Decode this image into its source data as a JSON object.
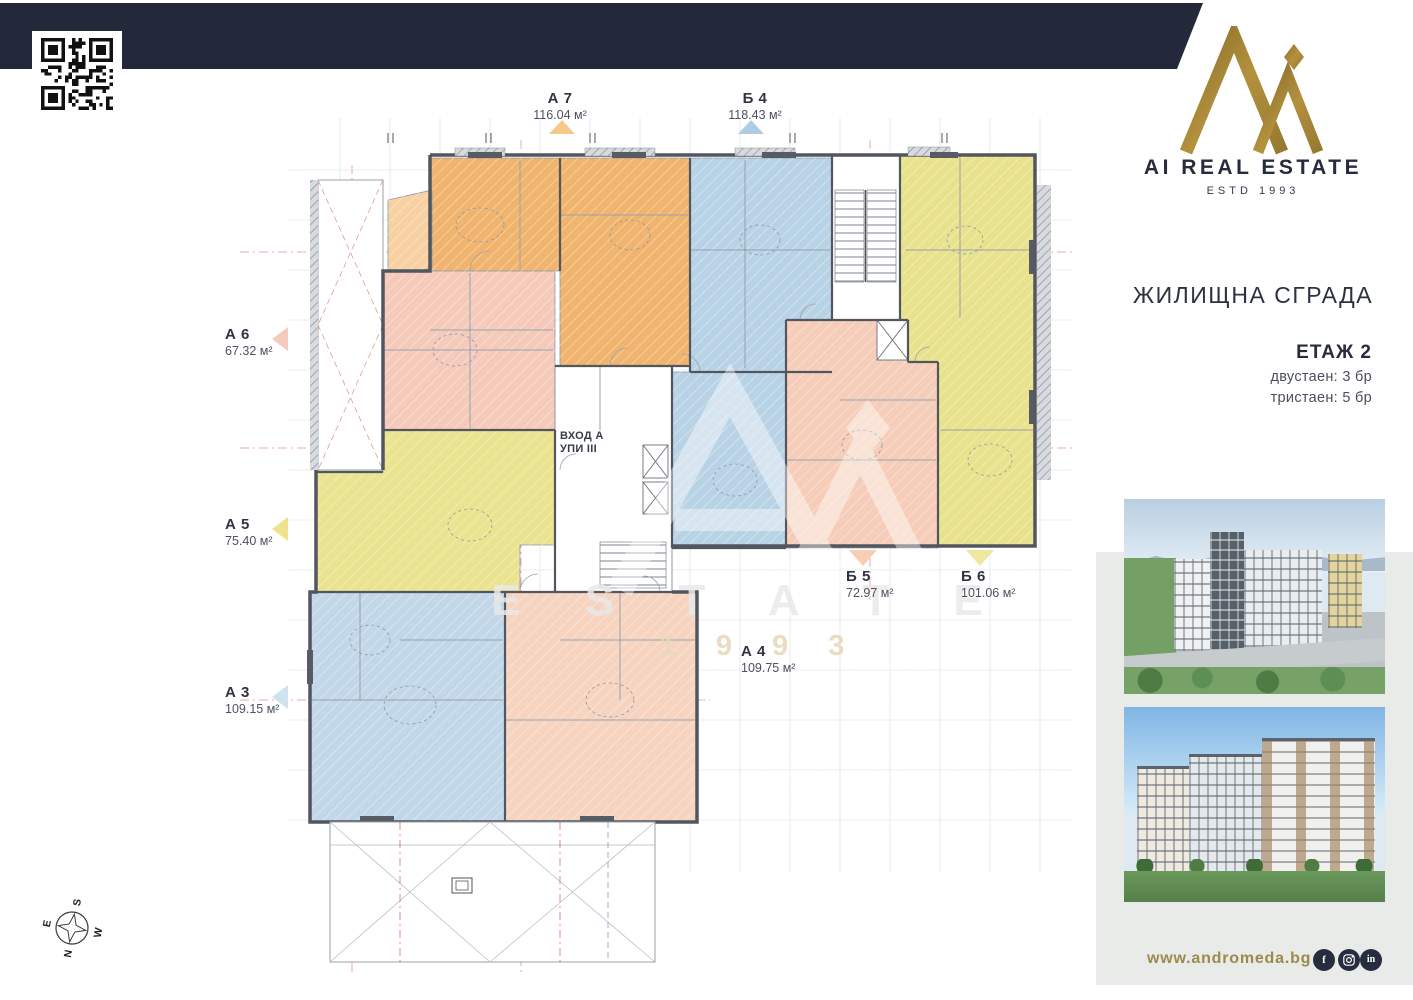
{
  "brand": {
    "name": "AI REAL ESTATE",
    "estd": "ESTD 1993"
  },
  "sidebar": {
    "project_title": "ЖИЛИЩНА СГРАДА",
    "floor_title": "ЕТАЖ 2",
    "unit_lines": [
      "двустаен: 3 бр",
      "тристаен: 5 бр"
    ],
    "website": "www.andromeda.bg",
    "social": [
      {
        "name": "facebook",
        "glyph": "f"
      },
      {
        "name": "instagram",
        "glyph": ""
      },
      {
        "name": "linkedin",
        "glyph": "in"
      }
    ],
    "accent_gold": "#9b8a4e",
    "navy": "#23283a"
  },
  "plan": {
    "entrance": {
      "line1": "ВХОД А",
      "line2": "УПИ III"
    },
    "watermark": {
      "line1": "E S T A T E",
      "line2": "1 9 9 3"
    },
    "compass": {
      "n": "N",
      "e": "E",
      "s": "S",
      "w": "W"
    },
    "apartments": [
      {
        "id": "А 7",
        "area": "116.04 м²",
        "marker": "up",
        "color": "#f5c98c"
      },
      {
        "id": "Б 4",
        "area": "118.43 м²",
        "marker": "up",
        "color": "#aecde4"
      },
      {
        "id": "А 6",
        "area": "67.32 м²",
        "marker": "left",
        "color": "#f6cabb"
      },
      {
        "id": "А 5",
        "area": "75.40 м²",
        "marker": "left",
        "color": "#eee28d"
      },
      {
        "id": "А 3",
        "area": "109.15 м²",
        "marker": "left",
        "color": "#cfe2ef"
      },
      {
        "id": "Б 5",
        "area": "72.97 м²",
        "marker": "down",
        "color": "#f8cdb4"
      },
      {
        "id": "Б 6",
        "area": "101.06 м²",
        "marker": "down",
        "color": "#efe6a0"
      },
      {
        "id": "А 4",
        "area": "109.75 м²",
        "marker": "none",
        "color": "#f6d4c0"
      }
    ],
    "zones": {
      "a7": "#f1b46e",
      "a7_terrace": "#f7d1a1",
      "b4": "#b9d3e6",
      "b5": "#f5cdb9",
      "b6": "#e9e28c",
      "a6": "#f5caba",
      "a5": "#eae390",
      "a3": "#c2d7e8",
      "a4": "#f6d4c0"
    }
  }
}
